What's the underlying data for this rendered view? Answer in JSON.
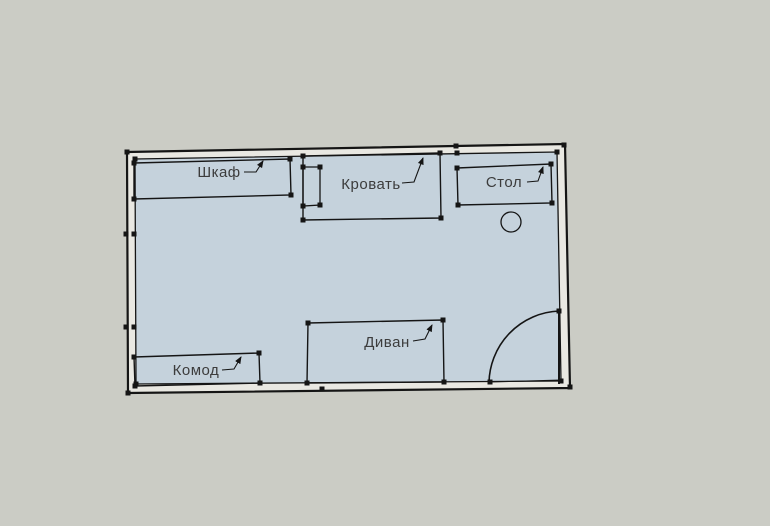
{
  "colors": {
    "background": "#cbccc5",
    "room_fill": "#c5d2dc",
    "wall_cavity": "#e9e8e2",
    "line": "#151515",
    "label": "#3c3c3c"
  },
  "room": {
    "outer_wall": [
      [
        127,
        152
      ],
      [
        565,
        144
      ],
      [
        570,
        388
      ],
      [
        128,
        393
      ]
    ],
    "inner_wall": [
      [
        135,
        159
      ],
      [
        557,
        152
      ],
      [
        561,
        381
      ],
      [
        136,
        384
      ]
    ]
  },
  "furniture": [
    {
      "name": "wardrobe",
      "label": "Шкаф",
      "poly": [
        [
          134,
          163
        ],
        [
          290,
          159
        ],
        [
          291,
          195
        ],
        [
          134,
          199
        ]
      ],
      "label_x": 219,
      "label_y": 177,
      "leader": [
        [
          244,
          172
        ],
        [
          256,
          172
        ],
        [
          263,
          161
        ]
      ]
    },
    {
      "name": "bed",
      "label": "Кровать",
      "poly": [
        [
          303,
          156
        ],
        [
          440,
          153
        ],
        [
          441,
          218
        ],
        [
          303,
          220
        ]
      ],
      "label_x": 371,
      "label_y": 189,
      "leader": [
        [
          402,
          183
        ],
        [
          414,
          182
        ],
        [
          423,
          158
        ]
      ]
    },
    {
      "name": "desk",
      "label": "Стол",
      "poly": [
        [
          457,
          168
        ],
        [
          551,
          164
        ],
        [
          552,
          203
        ],
        [
          458,
          205
        ]
      ],
      "label_x": 504,
      "label_y": 187,
      "leader": [
        [
          527,
          182
        ],
        [
          538,
          181
        ],
        [
          543,
          167
        ]
      ]
    },
    {
      "name": "sofa",
      "label": "Диван",
      "poly": [
        [
          308,
          323
        ],
        [
          443,
          320
        ],
        [
          444,
          382
        ],
        [
          307,
          383
        ]
      ],
      "label_x": 387,
      "label_y": 347,
      "leader": [
        [
          413,
          341
        ],
        [
          425,
          339
        ],
        [
          432,
          325
        ]
      ]
    },
    {
      "name": "dresser",
      "label": "Комод",
      "poly": [
        [
          134,
          357
        ],
        [
          259,
          353
        ],
        [
          260,
          383
        ],
        [
          135,
          386
        ]
      ],
      "label_x": 196,
      "label_y": 375,
      "leader": [
        [
          222,
          370
        ],
        [
          234,
          369
        ],
        [
          241,
          357
        ]
      ]
    }
  ],
  "bed_pillow": [
    [
      303,
      167
    ],
    [
      320,
      167
    ],
    [
      320,
      205
    ],
    [
      303,
      206
    ]
  ],
  "chair": {
    "cx": 511,
    "cy": 222,
    "r": 10
  },
  "door": {
    "leaf": [
      [
        559,
        311
      ],
      [
        559,
        384
      ]
    ],
    "arc": "M 559 311 A 73 73 0 0 0 489 384",
    "threshold": [
      [
        490,
        382
      ],
      [
        561,
        380
      ]
    ]
  },
  "wall_markers": [
    [
      127,
      152
    ],
    [
      135,
      159
    ],
    [
      456,
      146
    ],
    [
      457,
      153
    ],
    [
      564,
      145
    ],
    [
      557,
      152
    ],
    [
      570,
      387
    ],
    [
      561,
      381
    ],
    [
      128,
      393
    ],
    [
      136,
      384
    ],
    [
      126,
      234
    ],
    [
      134,
      234
    ],
    [
      126,
      327
    ],
    [
      134,
      327
    ],
    [
      559,
      311
    ],
    [
      490,
      382
    ],
    [
      322,
      389
    ]
  ]
}
